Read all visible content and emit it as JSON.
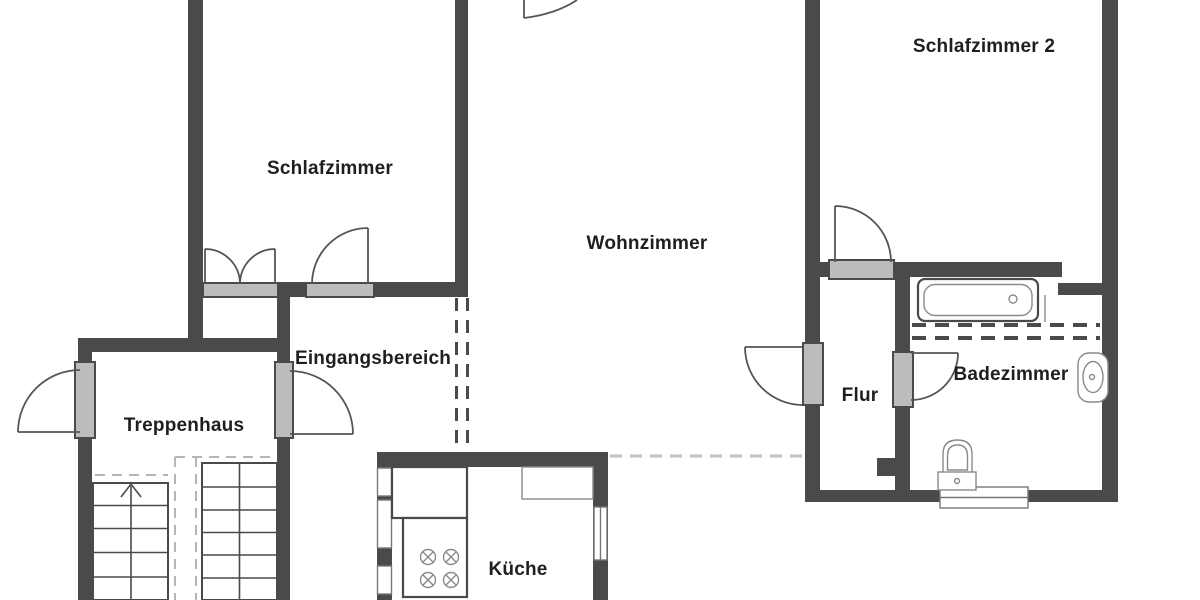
{
  "title": "Wohnung Grundriss",
  "colors": {
    "wall": "#4a4a4a",
    "door_sill": "#bcbcbc",
    "line": "#555555",
    "line_light": "#8a8a8a",
    "dash_light": "#c2c2c2",
    "dash_stair": "#b5b5b5",
    "text": "#1f1f1f",
    "bg": "#ffffff"
  },
  "rooms": [
    {
      "id": "schlafzimmer",
      "name": "Schlafzimmer"
    },
    {
      "id": "wohnzimmer",
      "name": "Wohnzimmer"
    },
    {
      "id": "schlafzimmer-2",
      "name": "Schlafzimmer 2"
    },
    {
      "id": "eingangsbereich",
      "name": "Eingangsbereich"
    },
    {
      "id": "treppenhaus",
      "name": "Treppenhaus"
    },
    {
      "id": "kueche",
      "name": "Küche"
    },
    {
      "id": "flur",
      "name": "Flur"
    },
    {
      "id": "badezimmer",
      "name": "Badezimmer"
    }
  ],
  "fixtures": [
    "bathtub",
    "washbasin",
    "toilet",
    "stove",
    "kitchen-counter",
    "stairs",
    "windows",
    "doors"
  ]
}
